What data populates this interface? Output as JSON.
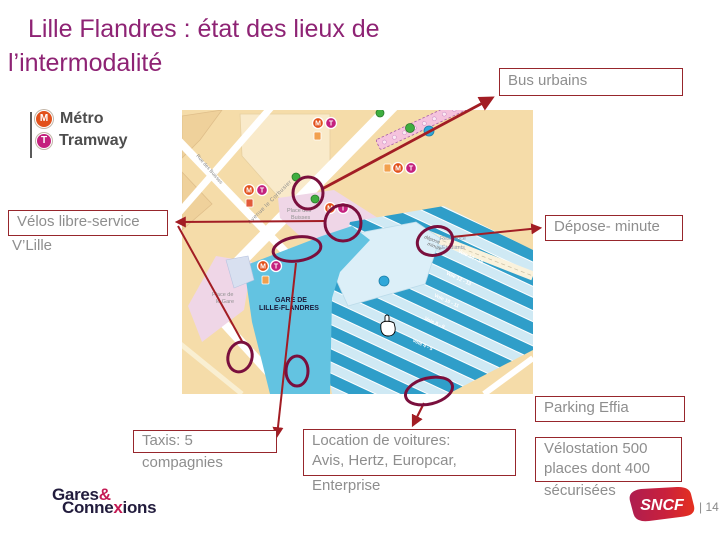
{
  "title": {
    "line1": "Lille Flandres : état des lieux de",
    "line2": "l’intermodalité"
  },
  "legend": {
    "metro_symbol": "M",
    "metro_label": "Métro",
    "tram_symbol": "T",
    "tram_label": "Tramway"
  },
  "callouts": {
    "bus_urbains": "Bus urbains",
    "velos_line1": "Vélos libre-service",
    "velos_overflow": "V’Lille",
    "depose_minute": "Dépose- minute",
    "parking_effia": "Parking Effia",
    "taxis_line1": "Taxis: 5",
    "taxis_overflow": "compagnies",
    "location_line1": "Location de voitures:",
    "location_line2": "Avis, Hertz, Europcar,",
    "location_overflow": "Enterprise",
    "velostation_line1": "Vélostation 500",
    "velostation_line2": "places dont 400",
    "velostation_overflow": "sécurisées"
  },
  "map": {
    "station_line1": "GARE DE",
    "station_line2": "LILLE-FLANDRES",
    "place_gare_line1": "Place de",
    "place_gare_line2": "le Gare",
    "place_buisses_line1": "Place des",
    "place_buisses_line2": "Buisses",
    "avenue": "Avenue le Corbusier",
    "rue": "Rue des Buisses",
    "residence_line1": "Résidence",
    "residence_line2": "Étudiants",
    "depose_line1": "dépose",
    "depose_line2": "minute",
    "metro_symbol": "M",
    "tram_symbol": "T",
    "tracks": [
      "Voie 14 - 16",
      "Voie 12 - 13",
      "Voie 10 - 11",
      "Voie 8 - 9",
      "Voie 4 - 5"
    ]
  },
  "footer": {
    "logo_gares": "Gares",
    "logo_amp": "&",
    "logo_conne": "Conne",
    "logo_x": "x",
    "logo_ions": "ions",
    "sncf": "SNCF",
    "page_number": "| 14"
  },
  "colors": {
    "title": "#8E2374",
    "callout_border": "#97262C",
    "callout_text": "#8E8E8E",
    "connector_line": "#A21D24",
    "highlight_ellipse": "#7A0F3D",
    "metro": "#E2511C",
    "tram": "#C4217E",
    "map_ground": "#F5DCA9",
    "map_tracks": "#2F9EC9",
    "map_concourse": "#63C3E1",
    "map_pink": "#EFD6E7",
    "gc_dark": "#221C3D",
    "gc_red": "#C41A54",
    "sncf_red_start": "#AE1E50",
    "sncf_red_end": "#E5301F"
  }
}
